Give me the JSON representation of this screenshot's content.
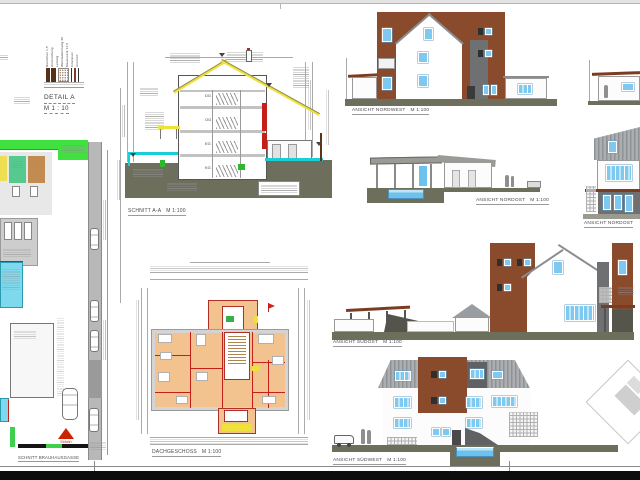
{
  "detail_a": {
    "title": "DETAIL A",
    "scale": "M 1 : 10",
    "layers": [
      "Riemchen 1,5",
      "Hinterlüftung",
      "Lattung",
      "Wärmedämmung 60",
      "Mauerwerk 11,5",
      "Innenputz",
      "Anstrich"
    ]
  },
  "site": {
    "caption": "SCHNITT BRAUHAUSGASSE",
    "einfahrt": "Einfahrt"
  },
  "section": {
    "caption": "SCHNITT A-A",
    "scale": "M 1:100",
    "floors": [
      "DG",
      "OG",
      "EG",
      "KG"
    ]
  },
  "plan": {
    "caption": "DACHGESCHOSS",
    "scale": "M 1:100"
  },
  "elevations": {
    "nordwest": {
      "caption": "ANSICHT NORDWEST",
      "scale": "M 1:100"
    },
    "nordost_pool": {
      "caption": "ANSICHT NORDOST",
      "scale": "M 1:100"
    },
    "nordost_side": {
      "caption": "ANSICHT NORDOST",
      "scale": ""
    },
    "suedost": {
      "caption": "ANSICHT SÜDOST",
      "scale": "M 1:100"
    },
    "suedwest": {
      "caption": "ANSICHT SÜDWEST",
      "scale": "M 1:100"
    }
  },
  "colors": {
    "brown": "#8a4a2c",
    "blue": "#7ec9ef",
    "olive": "#6e6e5c",
    "yellow": "#f0e03a",
    "cyan": "#17cfd4",
    "red": "#c4201a",
    "room": "#f2c28f",
    "pool": "#6cc2ec",
    "green": "#3fcf4f"
  }
}
